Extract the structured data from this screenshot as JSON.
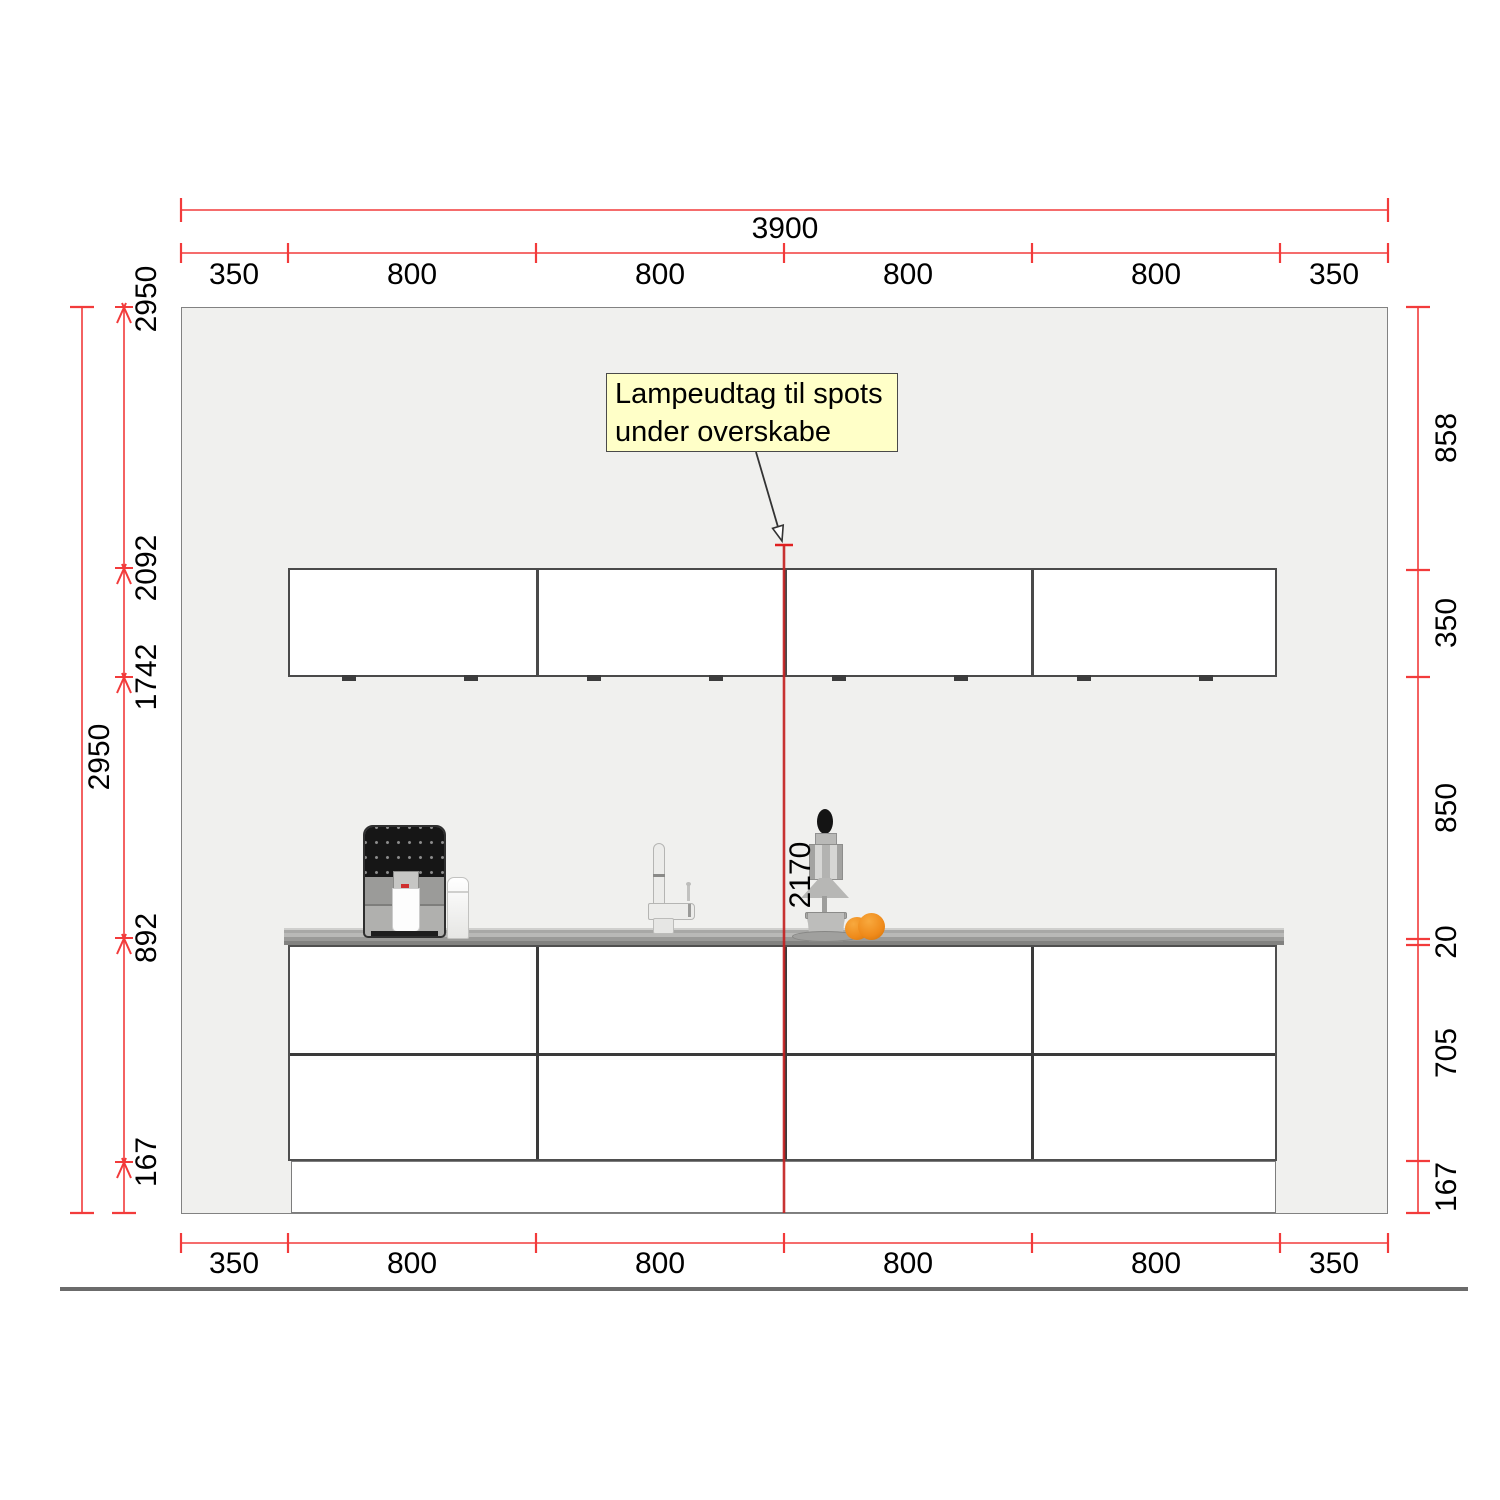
{
  "title": "kitchen-elevation-drawing",
  "annotation": {
    "line1": "Lampeudtag til spots",
    "line2": "under overskabe"
  },
  "dims": {
    "total_width": "3900",
    "overall_height": "2950",
    "top_segments": [
      "350",
      "800",
      "800",
      "800",
      "800",
      "350"
    ],
    "bottom_segments": [
      "350",
      "800",
      "800",
      "800",
      "800",
      "350"
    ],
    "left_chain": [
      "2950",
      "2092",
      "1742",
      "892",
      "167"
    ],
    "right_chain": [
      "858",
      "350",
      "850",
      "20",
      "705",
      "167"
    ],
    "lamp_outlet_height": "2170"
  },
  "colors": {
    "dimension_red": "#f23b3b",
    "lamp_line_red": "#c42222",
    "annotation_bg": "#ffffc8",
    "wall_fill": "#f0f0ee",
    "countertop_gray": "#a5a5a3",
    "orange_fruit": "#ef8a1a"
  }
}
